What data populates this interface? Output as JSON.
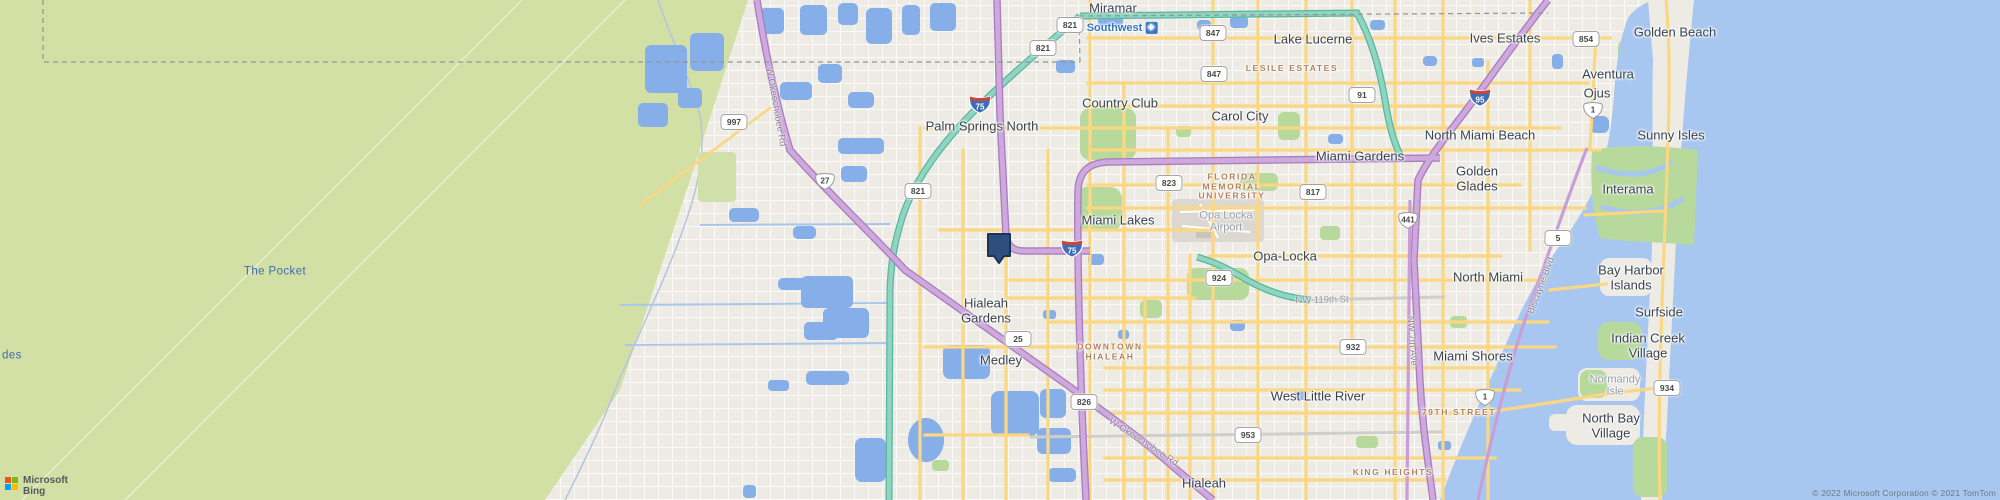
{
  "map": {
    "logo": {
      "line1": "Microsoft",
      "line2": "Bing"
    },
    "attribution": "© 2022 Microsoft Corporation © 2021 TomTom",
    "colors": {
      "water": "#a8c7f0",
      "lake": "#86aee9",
      "glades_green": "#d2e0a5",
      "park_green": "#b7d99c",
      "land": "#edebe4",
      "road_yellow": "#fbd781",
      "toll_teal": "#8fd5c1",
      "highway_purple": "#cfa9dd",
      "marker_navy": "#2e4e7e"
    },
    "marker": {
      "x": 999,
      "y": 265
    }
  },
  "labels": [
    {
      "t": "Miramar",
      "x": 1113,
      "y": 9,
      "c": ""
    },
    {
      "t": "Southwest",
      "x": 1122,
      "y": 28,
      "c": "apt",
      "icon": "airplane"
    },
    {
      "t": "Lake Lucerne",
      "x": 1313,
      "y": 40,
      "c": ""
    },
    {
      "t": "Ives Estates",
      "x": 1505,
      "y": 39,
      "c": ""
    },
    {
      "t": "Golden Beach",
      "x": 1675,
      "y": 33,
      "c": ""
    },
    {
      "t": "LESILE ESTATES",
      "x": 1292,
      "y": 69,
      "c": "cap"
    },
    {
      "t": "Aventura",
      "x": 1608,
      "y": 75,
      "c": ""
    },
    {
      "t": "Ojus",
      "x": 1597,
      "y": 94,
      "c": ""
    },
    {
      "t": "Country Club",
      "x": 1120,
      "y": 104,
      "c": ""
    },
    {
      "t": "Carol City",
      "x": 1240,
      "y": 117,
      "c": ""
    },
    {
      "t": "Palm Springs North",
      "x": 982,
      "y": 127,
      "c": ""
    },
    {
      "t": "North Miami Beach",
      "x": 1480,
      "y": 136,
      "c": ""
    },
    {
      "t": "Sunny Isles",
      "x": 1671,
      "y": 136,
      "c": ""
    },
    {
      "t": "Miami Gardens",
      "x": 1360,
      "y": 157,
      "c": ""
    },
    {
      "t": "Golden\nGlades",
      "x": 1477,
      "y": 179,
      "c": ""
    },
    {
      "t": "Interama",
      "x": 1628,
      "y": 190,
      "c": ""
    },
    {
      "t": "FLORIDA\nMEMORIAL\nUNIVERSITY",
      "x": 1232,
      "y": 187,
      "c": "cap"
    },
    {
      "t": "Miami Lakes",
      "x": 1118,
      "y": 221,
      "c": ""
    },
    {
      "t": "Opa Locka\nAirport",
      "x": 1226,
      "y": 222,
      "c": "gray"
    },
    {
      "t": "Opa-Locka",
      "x": 1285,
      "y": 257,
      "c": ""
    },
    {
      "t": "North Miami",
      "x": 1488,
      "y": 278,
      "c": ""
    },
    {
      "t": "Bay Harbor\nIslands",
      "x": 1631,
      "y": 278,
      "c": ""
    },
    {
      "t": "The Pocket",
      "x": 275,
      "y": 272,
      "c": "water"
    },
    {
      "t": "des",
      "x": 2,
      "y": 356,
      "c": "water left"
    },
    {
      "t": "Hialeah\nGardens",
      "x": 986,
      "y": 311,
      "c": ""
    },
    {
      "t": "Surfside",
      "x": 1659,
      "y": 313,
      "c": ""
    },
    {
      "t": "DOWNTOWN\nHIALEAH",
      "x": 1110,
      "y": 352,
      "c": "cap"
    },
    {
      "t": "Indian Creek\nVillage",
      "x": 1648,
      "y": 346,
      "c": ""
    },
    {
      "t": "Miami Shores",
      "x": 1473,
      "y": 357,
      "c": ""
    },
    {
      "t": "Medley",
      "x": 1001,
      "y": 361,
      "c": ""
    },
    {
      "t": "Normandy\nIsle",
      "x": 1615,
      "y": 386,
      "c": "gray"
    },
    {
      "t": "West Little River",
      "x": 1318,
      "y": 397,
      "c": ""
    },
    {
      "t": "79TH STREET",
      "x": 1459,
      "y": 413,
      "c": "cap"
    },
    {
      "t": "North Bay\nVillage",
      "x": 1611,
      "y": 426,
      "c": ""
    },
    {
      "t": "KING HEIGHTS",
      "x": 1393,
      "y": 473,
      "c": "cap"
    },
    {
      "t": "Hialeah",
      "x": 1204,
      "y": 484,
      "c": ""
    },
    {
      "t": "W Okeechobee Rd",
      "x": 775,
      "y": 107,
      "c": "road",
      "r": 80
    },
    {
      "t": "W Okeechobee Rd",
      "x": 1143,
      "y": 443,
      "c": "road",
      "r": 33
    },
    {
      "t": "NW 119th St",
      "x": 1322,
      "y": 301,
      "c": "roadgray",
      "r": -1
    },
    {
      "t": "NW 7th Ave",
      "x": 1411,
      "y": 341,
      "c": "road",
      "r": 86
    },
    {
      "t": "Biscayne Blvd",
      "x": 1542,
      "y": 286,
      "c": "road",
      "r": -69
    }
  ],
  "shields": [
    {
      "t": "821",
      "x": 1070,
      "y": 25,
      "k": "st"
    },
    {
      "t": "821",
      "x": 1043,
      "y": 48,
      "k": "st"
    },
    {
      "t": "847",
      "x": 1213,
      "y": 33,
      "k": "st"
    },
    {
      "t": "847",
      "x": 1214,
      "y": 74,
      "k": "st"
    },
    {
      "t": "854",
      "x": 1586,
      "y": 39,
      "k": "st"
    },
    {
      "t": "91",
      "x": 1362,
      "y": 95,
      "k": "st"
    },
    {
      "t": "997",
      "x": 734,
      "y": 122,
      "k": "st"
    },
    {
      "t": "823",
      "x": 1169,
      "y": 183,
      "k": "st"
    },
    {
      "t": "821",
      "x": 918,
      "y": 191,
      "k": "st"
    },
    {
      "t": "817",
      "x": 1313,
      "y": 192,
      "k": "st"
    },
    {
      "t": "5",
      "x": 1558,
      "y": 238,
      "k": "st"
    },
    {
      "t": "924",
      "x": 1219,
      "y": 278,
      "k": "st"
    },
    {
      "t": "25",
      "x": 1018,
      "y": 339,
      "k": "st"
    },
    {
      "t": "932",
      "x": 1353,
      "y": 347,
      "k": "st"
    },
    {
      "t": "826",
      "x": 1084,
      "y": 402,
      "k": "st"
    },
    {
      "t": "953",
      "x": 1248,
      "y": 435,
      "k": "st"
    },
    {
      "t": "934",
      "x": 1667,
      "y": 388,
      "k": "st"
    },
    {
      "t": "27",
      "x": 825,
      "y": 181,
      "k": "us"
    },
    {
      "t": "441",
      "x": 1408,
      "y": 220,
      "k": "us"
    },
    {
      "t": "1",
      "x": 1593,
      "y": 110,
      "k": "us"
    },
    {
      "t": "1",
      "x": 1485,
      "y": 397,
      "k": "us"
    },
    {
      "t": "75",
      "x": 980,
      "y": 104,
      "k": "i"
    },
    {
      "t": "75",
      "x": 1072,
      "y": 248,
      "k": "i"
    },
    {
      "t": "95",
      "x": 1480,
      "y": 97,
      "k": "i"
    }
  ]
}
